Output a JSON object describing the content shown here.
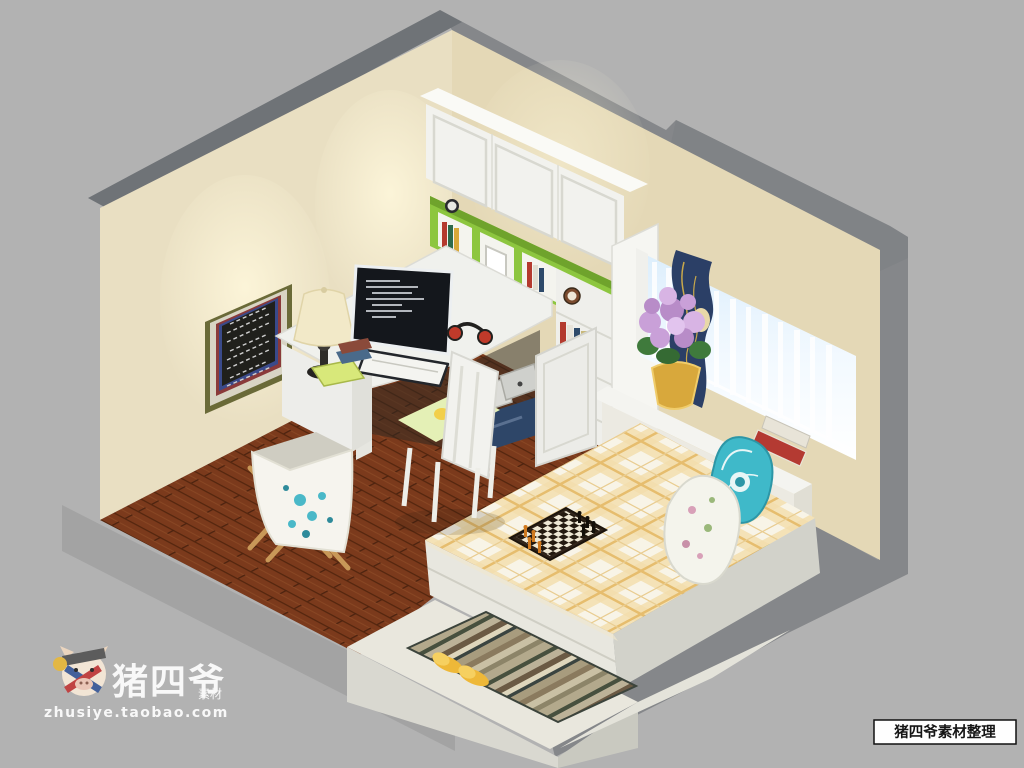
{
  "watermark": {
    "brand": "猪四爷",
    "brand_small": "素材",
    "url": "zhusiye.taobao.com"
  },
  "footer_tag": "猪四爷素材整理",
  "palette": {
    "background": "#b2b2b2",
    "block_gray": "#85878a",
    "wall_top_gray": "#6f7377",
    "wall_beige": "#e9dfc2",
    "window_wall_beige": "#e4d8b6",
    "wood_floor": "#7b3a1c",
    "shelf_green": "#8dc63f",
    "furniture_white": "#f1f1ed",
    "curtain_navy": "#2b3f66",
    "curtain_gold": "#c8a84b",
    "bedding_plaid_tan": "#f3ddab",
    "pillow_teal": "#3fb9c9",
    "cushion_green": "#e4f0b6",
    "slippers_yellow": "#eeb838",
    "flower_purple": "#c9a0d8",
    "flower_pot_gold": "#d8a83c",
    "blackboard": "#20201c",
    "monitor_screen": "#14171c",
    "storage_navy": "#2e4668"
  }
}
